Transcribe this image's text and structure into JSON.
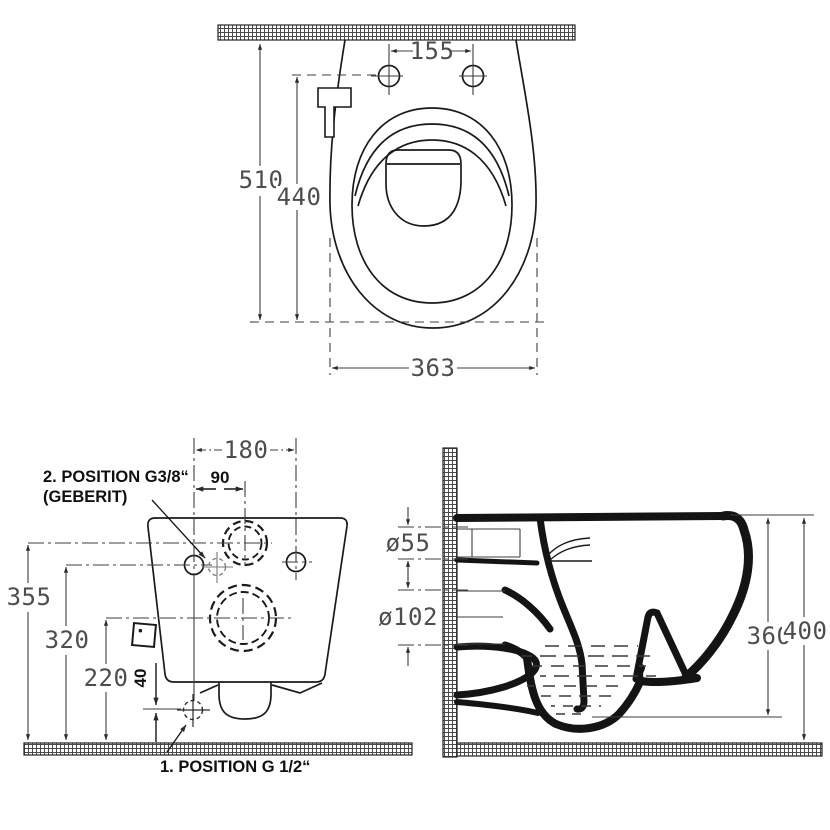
{
  "drawing": {
    "type": "technical-drawing",
    "subject": "wall-hung toilet, three orthographic dimensioned views",
    "colors": {
      "background": "#ffffff",
      "drawing_line": "#1a1a1a",
      "dimension_line": "#3d3d3d",
      "dimension_text": "#4d4d4d",
      "label_text": "#101010"
    },
    "top_view": {
      "dims": {
        "hole_spacing": "155",
        "depth_total": "510",
        "depth_bowl": "440",
        "width": "363"
      }
    },
    "front_view": {
      "dims": {
        "fixing_width": "180",
        "supply_offset": "90",
        "supply_height": "355",
        "fixing_height": "320",
        "drain_height": "220",
        "bottom_offset": "40"
      },
      "labels": {
        "position2_line1": "2. POSITION G3/8“",
        "position2_line2": "(GEBERIT)",
        "position1": "1. POSITION G 1/2“"
      }
    },
    "side_view": {
      "dims": {
        "supply_diameter": "ø55",
        "drain_diameter": "ø102",
        "height_body": "360",
        "height_total": "400"
      }
    }
  }
}
